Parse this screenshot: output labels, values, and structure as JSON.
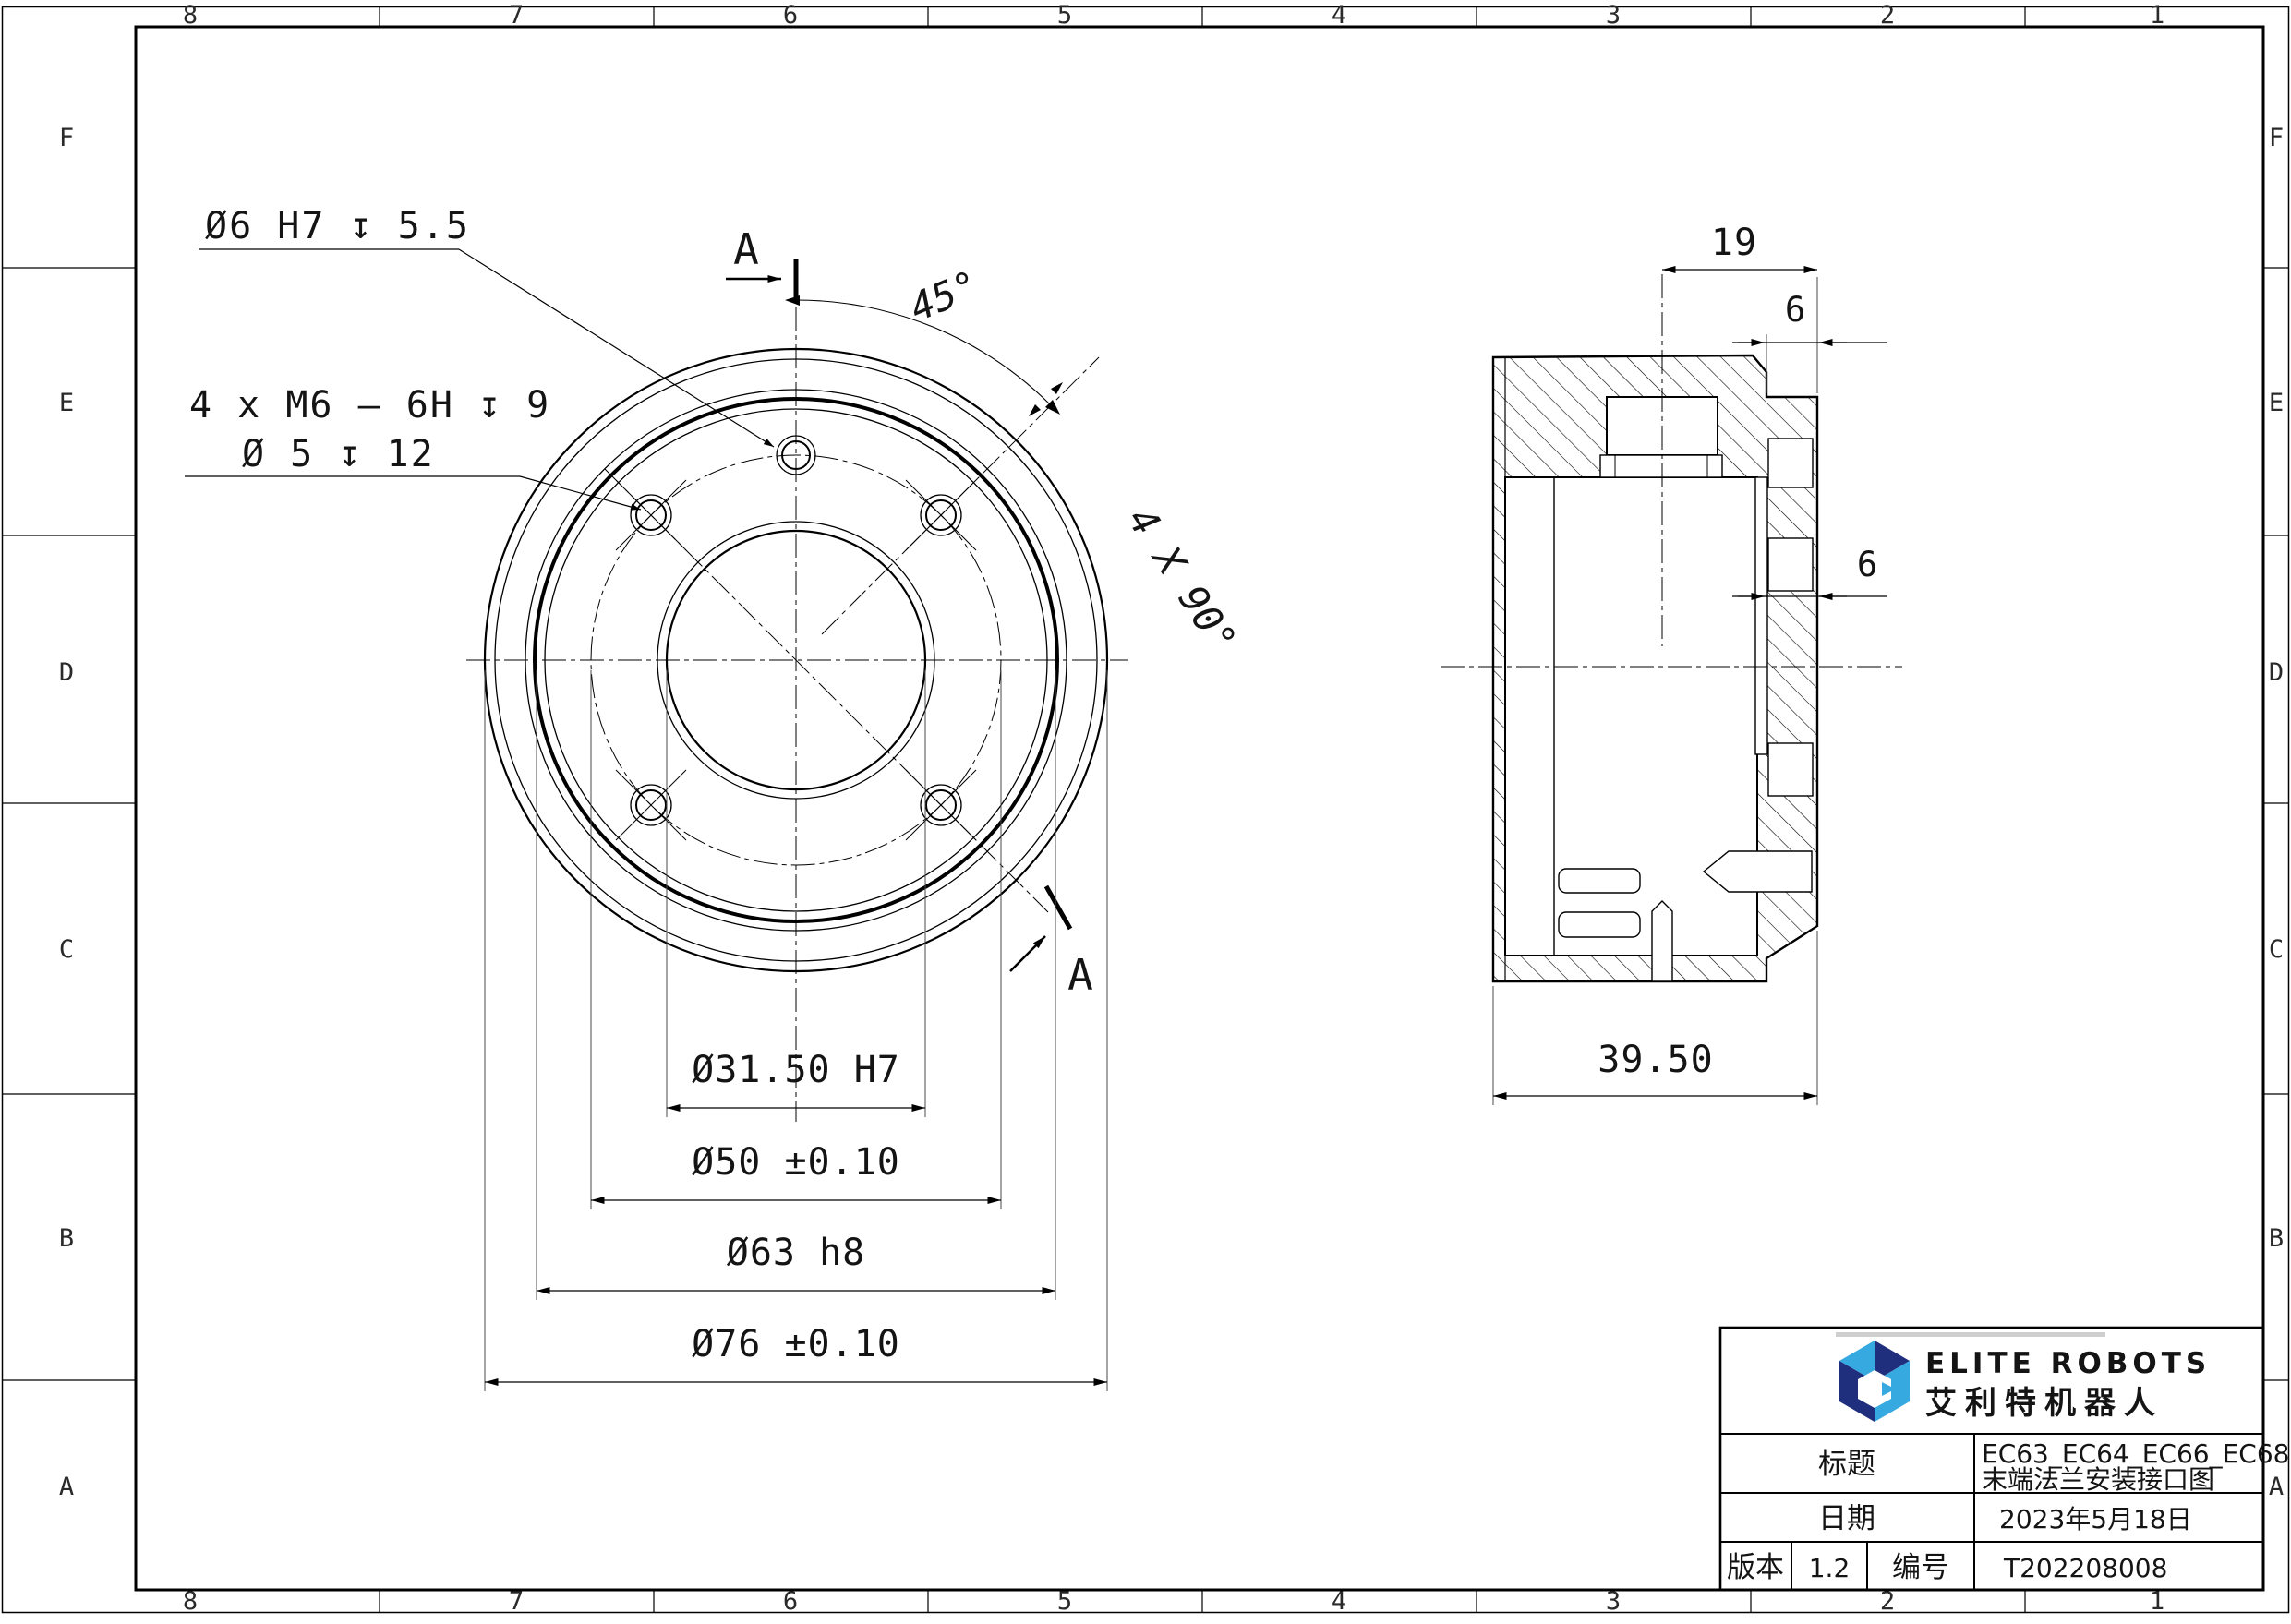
{
  "sheet": {
    "zones": {
      "cols": [
        "8",
        "7",
        "6",
        "5",
        "4",
        "3",
        "2",
        "1"
      ],
      "rows": [
        "F",
        "E",
        "D",
        "C",
        "B",
        "A"
      ]
    },
    "front_view": {
      "callout_dowel_hole": "Ø6 H7 ↧ 5.5",
      "callout_threaded_holes_line1": "4 x M6 – 6H ↧ 9",
      "callout_threaded_holes_line2": "Ø 5 ↧ 12",
      "angle_dim": "45°",
      "pattern_angle_dim": "4 X 90°",
      "section_marker_top": "A",
      "section_marker_bottom": "A",
      "dim_bore": "Ø31.50 H7",
      "dim_bolt_circle": "Ø50 ±0.10",
      "dim_boss": "Ø63 h8",
      "dim_outer": "Ø76 ±0.10"
    },
    "section_view": {
      "dim_hole_offset": "19",
      "dim_boss_height": "6",
      "dim_plate_thickness": "6",
      "dim_overall_depth": "39.50"
    },
    "title_block": {
      "brand_en": "ELITE ROBOTS",
      "brand_cn": "艾利特机器人",
      "title_label": "标题",
      "title_value_line1": "EC63_EC64_EC66_EC68",
      "title_value_line2": "末端法兰安装接口图",
      "date_label": "日期",
      "date_value": "2023年5月18日",
      "version_label": "版本",
      "version_value": "1.2",
      "number_label": "编号",
      "number_value": "T202208008"
    },
    "colors": {
      "brand_dark": "#202e7e",
      "brand_light": "#36a9e1",
      "line": "#000000"
    }
  }
}
